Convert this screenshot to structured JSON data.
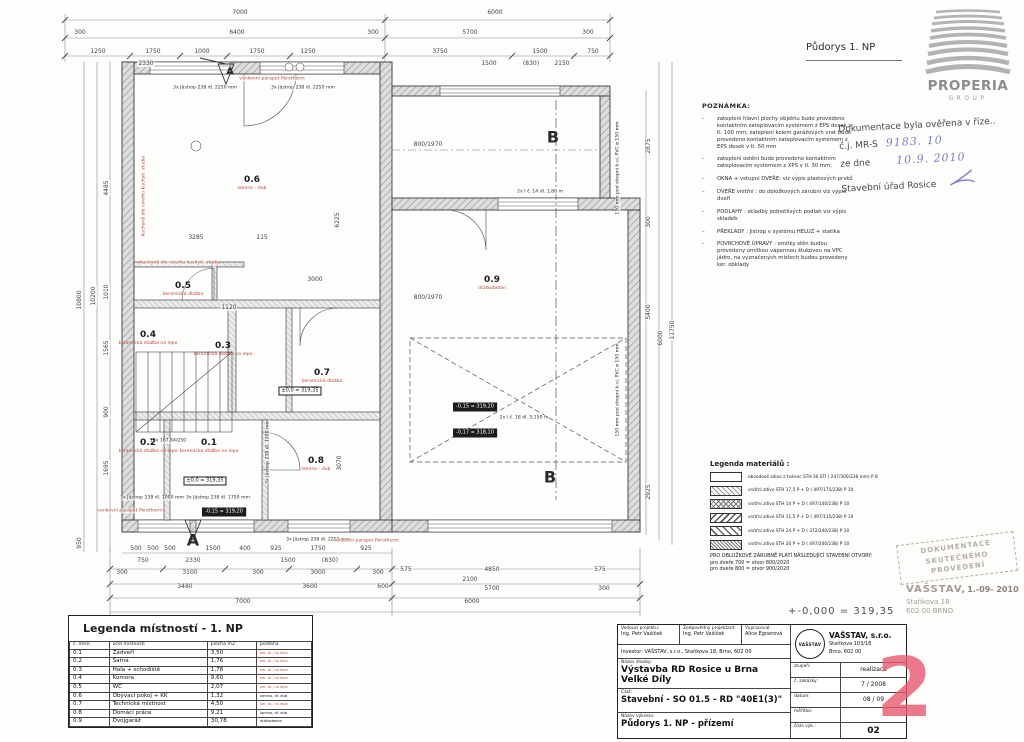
{
  "title": "Půdorys 1. NP",
  "logo": {
    "name": "PROPERIA",
    "sub": "GROUP"
  },
  "verification": {
    "l1": "Dokumentace byla ověřena v říze..",
    "cj_label": "č.j. MR-S",
    "cj_value": "9183. 10",
    "zd_label": "ze dne",
    "zd_value": "10.9. 2010",
    "office": "Stavební úřad Rosice"
  },
  "notes": {
    "title": "POZNÁMKA:",
    "items": [
      "zateplení hlavní plochy objektu bude provedeno kontaktním zateplovacím systémem z EPS desek v tl. 100 mm; zateplení kolem garážových vrat bude provedeno kontaktním zateplovacím systémem z EPS desek v tl. 50 mm",
      "zateplení ostění bude provedeno kontaktním zateplovacím systémem z XPS v tl. 30 mm;",
      "OKNA + vstupní DVEŘE: viz výpis plastových prvků",
      "DVEŘE vnitřní : do obložkových zárubní viz výpis dveří",
      "PODLAHY : skladby jednotlivých podlah viz výpis skladeb",
      "PŘEKLADY : Jistrop v systému HELUZ + statika",
      "POVRCHOVÉ ÚPRAVY : omítky stěn budou provedeny omítkou vápennou štukovou na VPC jádro, na vyznačených místech budou provedeny ker. obklady"
    ]
  },
  "materials_legend": {
    "title": "Legenda materiálů :",
    "rows": [
      {
        "hatch": "h0",
        "label": "obvodové zdivo z tvárnic STH 30 STI ( 247/300/238 mm)  P 8"
      },
      {
        "hatch": "h1",
        "label": "vnitřní zdivo STH 17,5 P + D ( 497/175/238)  P 10"
      },
      {
        "hatch": "h2",
        "label": "vnitřní zdivo STH 14 P + D ( 497/140/238)  P 10"
      },
      {
        "hatch": "h3",
        "label": "vnitřní zdivo STH 11,5 P + D ( 497/115/238)  P 10"
      },
      {
        "hatch": "h4",
        "label": "vnitřní zdivo STH 24 P + D ( 372/240/238)  P 10"
      },
      {
        "hatch": "h5",
        "label": "vnitřní zdivo STH 20 P + D ( 497/200/238)  P 10"
      }
    ],
    "footer": [
      "PRO OBLOŽKOVÉ ZÁRUBNĚ PLATÍ NÁSLEDUJÍCÍ STAVEBNÍ OTVORY:",
      "pro dveře 700  =  otvor 800/2020",
      "pro dveře 800  =  otvor 900/2020"
    ]
  },
  "elevation_note": "+-0,000 = 319,35",
  "stamps": {
    "doc1": "DOKUMENTACE",
    "doc2": "SKUTEČNÉHO PROVEDENÍ",
    "name": "VAŠSTAV,",
    "date": "1.-09- 2010",
    "addr1": "Staňkova 18",
    "addr2": "602 00 BRNO"
  },
  "rooms_legend": {
    "title": "Legenda místností - 1. NP",
    "headers": [
      "č. mísn.",
      "účel místnosti",
      "plocha m2",
      "podlaha"
    ],
    "rows": [
      {
        "no": "0.1",
        "name": "Zádveří",
        "area": "3,50",
        "floor": "ker. dl., na lepe",
        "fc": "r"
      },
      {
        "no": "0.2",
        "name": "Šatna",
        "area": "1,76",
        "floor": "ker. dl., na lepe",
        "fc": "r"
      },
      {
        "no": "0.3",
        "name": "Hala + schodiště",
        "area": "1,78",
        "floor": "ker. dl., na lepe",
        "fc": "r"
      },
      {
        "no": "0.4",
        "name": "Komora",
        "area": "9,60",
        "floor": "ker. dl., na lepe",
        "fc": "r"
      },
      {
        "no": "0.5",
        "name": "WC",
        "area": "2,07",
        "floor": "ker. dl., na lepe",
        "fc": "r"
      },
      {
        "no": "0.6",
        "name": "Obývací pokoj + KK",
        "area": "1,32",
        "floor": "lamino, dř. dub",
        "fc": "b"
      },
      {
        "no": "0.7",
        "name": "Technická místnost",
        "area": "4,50",
        "floor": "ker. dl., na lepe",
        "fc": "r"
      },
      {
        "no": "0.8",
        "name": "Domácí práce",
        "area": "9,21",
        "floor": "lamino, dř. dub",
        "fc": "b"
      },
      {
        "no": "0.9",
        "name": "Dvojgaráž",
        "area": "30,78",
        "floor": "drátkobeton",
        "fc": "b"
      }
    ]
  },
  "title_block": {
    "lead_label": "Vedoucí projektu:",
    "lead": "Ing. Petr Vašíček",
    "resp_label": "Zodpovědný projektant:",
    "resp": "Ing. Petr Vašíček",
    "drafted_label": "Vypracoval:",
    "drafted": "Alice Egnerová",
    "investor": "Investor:   VAŠSTAV, s.r.o.,   Staňkova 18, Brno, 602 00",
    "stavba_label": "Název stavby:",
    "stavba1": "Výstavba RD Rosice u Brna",
    "stavba2": "Velké Díly",
    "cast_label": "Část:",
    "cast": "Stavební - SO 01.5 - RD \"40E1(3)\"",
    "vykres_label": "Název výkresu:",
    "vykres": "Půdorys 1. NP - přízemí",
    "emblem": "VAŠSTAV",
    "firm": "VAŠSTAV, s.r.o.",
    "firm_addr1": "Staňkova 103/18",
    "firm_addr2": "Brno, 602 00",
    "f1l": "stupeň:",
    "f1v": "realizace",
    "f2l": "č. zakázky:",
    "f2v": "7 / 2008",
    "f3l": "datum:",
    "f3v": "08 / 09",
    "f4l": "měřítko:",
    "f4v": "",
    "f5l": "číslo výk.:",
    "f5v": "02",
    "big": "2"
  },
  "plan": {
    "dims": [
      {
        "t": "7000",
        "x": 240,
        "y": 13
      },
      {
        "t": "6000",
        "x": 495,
        "y": 13
      },
      {
        "t": "300",
        "x": 80,
        "y": 33
      },
      {
        "t": "6400",
        "x": 237,
        "y": 33
      },
      {
        "t": "300",
        "x": 373,
        "y": 33
      },
      {
        "t": "5700",
        "x": 470,
        "y": 33
      },
      {
        "t": "300",
        "x": 588,
        "y": 33
      },
      {
        "t": "1250",
        "x": 98,
        "y": 52
      },
      {
        "t": "1750",
        "x": 153,
        "y": 52
      },
      {
        "t": "1000",
        "x": 202,
        "y": 52
      },
      {
        "t": "1750",
        "x": 257,
        "y": 52
      },
      {
        "t": "1250",
        "x": 308,
        "y": 52
      },
      {
        "t": "3750",
        "x": 440,
        "y": 52
      },
      {
        "t": "1500",
        "x": 540,
        "y": 52
      },
      {
        "t": "750",
        "x": 593,
        "y": 52
      },
      {
        "t": "2330",
        "x": 146,
        "y": 64
      },
      {
        "t": "1500",
        "x": 489,
        "y": 64
      },
      {
        "t": "(830)",
        "x": 531,
        "y": 64
      },
      {
        "t": "2150",
        "x": 562,
        "y": 64
      },
      {
        "t": "10800",
        "x": 80,
        "y": 300,
        "v": 1
      },
      {
        "t": "10200",
        "x": 94,
        "y": 296,
        "v": 1
      },
      {
        "t": "4485",
        "x": 107,
        "y": 188,
        "v": 1
      },
      {
        "t": "1010",
        "x": 107,
        "y": 292,
        "v": 1
      },
      {
        "t": "1565",
        "x": 107,
        "y": 348,
        "v": 1
      },
      {
        "t": "900",
        "x": 107,
        "y": 412,
        "v": 1
      },
      {
        "t": "1695",
        "x": 107,
        "y": 468,
        "v": 1
      },
      {
        "t": "950",
        "x": 80,
        "y": 543,
        "v": 1
      },
      {
        "t": "2875",
        "x": 649,
        "y": 146,
        "v": 1
      },
      {
        "t": "300",
        "x": 649,
        "y": 222,
        "v": 1
      },
      {
        "t": "5400",
        "x": 649,
        "y": 312,
        "v": 1
      },
      {
        "t": "6000",
        "x": 661,
        "y": 338,
        "v": 1
      },
      {
        "t": "11750",
        "x": 673,
        "y": 330,
        "v": 1
      },
      {
        "t": "2925",
        "x": 649,
        "y": 492,
        "v": 1
      },
      {
        "t": "3285",
        "x": 196,
        "y": 238
      },
      {
        "t": "115",
        "x": 262,
        "y": 238
      },
      {
        "t": "6225",
        "x": 338,
        "y": 220,
        "v": 1
      },
      {
        "t": "3000",
        "x": 315,
        "y": 280
      },
      {
        "t": "1120",
        "x": 229,
        "y": 308
      },
      {
        "t": "3070",
        "x": 340,
        "y": 463,
        "v": 1
      },
      {
        "t": "800/1970",
        "x": 428,
        "y": 145
      },
      {
        "t": "800/1970",
        "x": 428,
        "y": 298
      },
      {
        "t": "500",
        "x": 136,
        "y": 549
      },
      {
        "t": "500",
        "x": 153,
        "y": 549
      },
      {
        "t": "500",
        "x": 170,
        "y": 549
      },
      {
        "t": "1500",
        "x": 213,
        "y": 549
      },
      {
        "t": "400",
        "x": 245,
        "y": 549
      },
      {
        "t": "925",
        "x": 276,
        "y": 549
      },
      {
        "t": "1750",
        "x": 318,
        "y": 549
      },
      {
        "t": "925",
        "x": 366,
        "y": 549
      },
      {
        "t": "750",
        "x": 143,
        "y": 561
      },
      {
        "t": "2330",
        "x": 193,
        "y": 561
      },
      {
        "t": "1500",
        "x": 288,
        "y": 561
      },
      {
        "t": "(830)",
        "x": 330,
        "y": 561
      },
      {
        "t": "300",
        "x": 122,
        "y": 573
      },
      {
        "t": "3100",
        "x": 190,
        "y": 573
      },
      {
        "t": "300",
        "x": 258,
        "y": 573
      },
      {
        "t": "3000",
        "x": 318,
        "y": 573
      },
      {
        "t": "300",
        "x": 378,
        "y": 573
      },
      {
        "t": "575",
        "x": 406,
        "y": 570
      },
      {
        "t": "4850",
        "x": 492,
        "y": 570
      },
      {
        "t": "575",
        "x": 600,
        "y": 570
      },
      {
        "t": "3480",
        "x": 185,
        "y": 587
      },
      {
        "t": "3600",
        "x": 310,
        "y": 587
      },
      {
        "t": "600",
        "x": 383,
        "y": 587
      },
      {
        "t": "2100",
        "x": 470,
        "y": 580
      },
      {
        "t": "5700",
        "x": 492,
        "y": 589
      },
      {
        "t": "300",
        "x": 604,
        "y": 589
      },
      {
        "t": "7000",
        "x": 243,
        "y": 602
      },
      {
        "t": "6000",
        "x": 472,
        "y": 602
      }
    ],
    "annotations": [
      {
        "t": "3x Jästrop 238 dl. 2250 mm",
        "x": 205,
        "y": 88
      },
      {
        "t": "3x Jästrop 238 dl. 2250 mm",
        "x": 303,
        "y": 88
      },
      {
        "t": "3x Jästrop 238 dl. 1000 mm",
        "x": 152,
        "y": 498
      },
      {
        "t": "3x Jästrop 238 dl. 1750 mm",
        "x": 218,
        "y": 498
      },
      {
        "t": "3x Jästrop 238 dl. 2250 mm",
        "x": 318,
        "y": 540
      },
      {
        "t": "2x I č. 14 dl. 1,80 m",
        "x": 540,
        "y": 192
      },
      {
        "t": "2x I č. 18 dl. 5,150 m",
        "x": 524,
        "y": 418
      },
      {
        "t": "17x 167,84/250",
        "x": 168,
        "y": 441
      },
      {
        "t": "3x Jästrop 238 dl. 1500 mm",
        "x": 268,
        "y": 452,
        "v": 1
      },
      {
        "t": "kuchyně dle návrhu kuchyň. studia",
        "x": 144,
        "y": 196,
        "v": 1,
        "r": 1
      },
      {
        "t": "kuchyně dle návrhu kuchyň. studia",
        "x": 180,
        "y": 263,
        "r": 1
      },
      {
        "t": "venkovní parapet Porotherm",
        "x": 272,
        "y": 79,
        "r": 1
      },
      {
        "t": "venkovní parapet Porotherm",
        "x": 130,
        "y": 511,
        "r": 1
      },
      {
        "t": "venkovní parapet Porotherm",
        "x": 366,
        "y": 541,
        "r": 1
      },
      {
        "t": "150 mm pod stropní k-cí, PVC ø 150 mm",
        "x": 618,
        "y": 168,
        "v": 1
      },
      {
        "t": "150 mm pod stropní k-cí, PVC ø 150 mm",
        "x": 618,
        "y": 390,
        "v": 1
      }
    ],
    "rooms": [
      {
        "no": "0.1",
        "fl": "keramická dlažba na lepe",
        "x": 209,
        "y": 446
      },
      {
        "no": "0.2",
        "fl": "keramická dlažba na lepe",
        "x": 148,
        "y": 446
      },
      {
        "no": "0.3",
        "fl": "keramická dlažba na lepe",
        "x": 223,
        "y": 349
      },
      {
        "no": "0.4",
        "fl": "keramická dlažba na lepe",
        "x": 148,
        "y": 338
      },
      {
        "no": "0.5",
        "fl": "keramická dlažba",
        "x": 183,
        "y": 289
      },
      {
        "no": "0.6",
        "fl": "lamino - dub",
        "x": 252,
        "y": 183
      },
      {
        "no": "0.7",
        "fl": "keramická dlažba",
        "x": 322,
        "y": 376
      },
      {
        "no": "0.8",
        "fl": "lamino - dub",
        "x": 316,
        "y": 464
      },
      {
        "no": "0.9",
        "fl": "drátkobeton",
        "x": 492,
        "y": 283
      }
    ],
    "levels": [
      {
        "t": "±0,0 = 319,35",
        "x": 205,
        "y": 481,
        "o": 1
      },
      {
        "t": "±0,0 = 319,35",
        "x": 300,
        "y": 391,
        "o": 1
      },
      {
        "t": "-0,15 = 319,20",
        "x": 475,
        "y": 407
      },
      {
        "t": "-0,17 = 318,10",
        "x": 475,
        "y": 433
      },
      {
        "t": "-0,15 = 319,20",
        "x": 224,
        "y": 512
      }
    ],
    "marks": [
      {
        "t": "A",
        "x": 230,
        "y": 72,
        "s": 10
      },
      {
        "t": "A",
        "x": 193,
        "y": 540,
        "s": 16
      },
      {
        "t": "B",
        "x": 553,
        "y": 137,
        "s": 16
      },
      {
        "t": "B",
        "x": 550,
        "y": 477,
        "s": 16
      }
    ]
  }
}
